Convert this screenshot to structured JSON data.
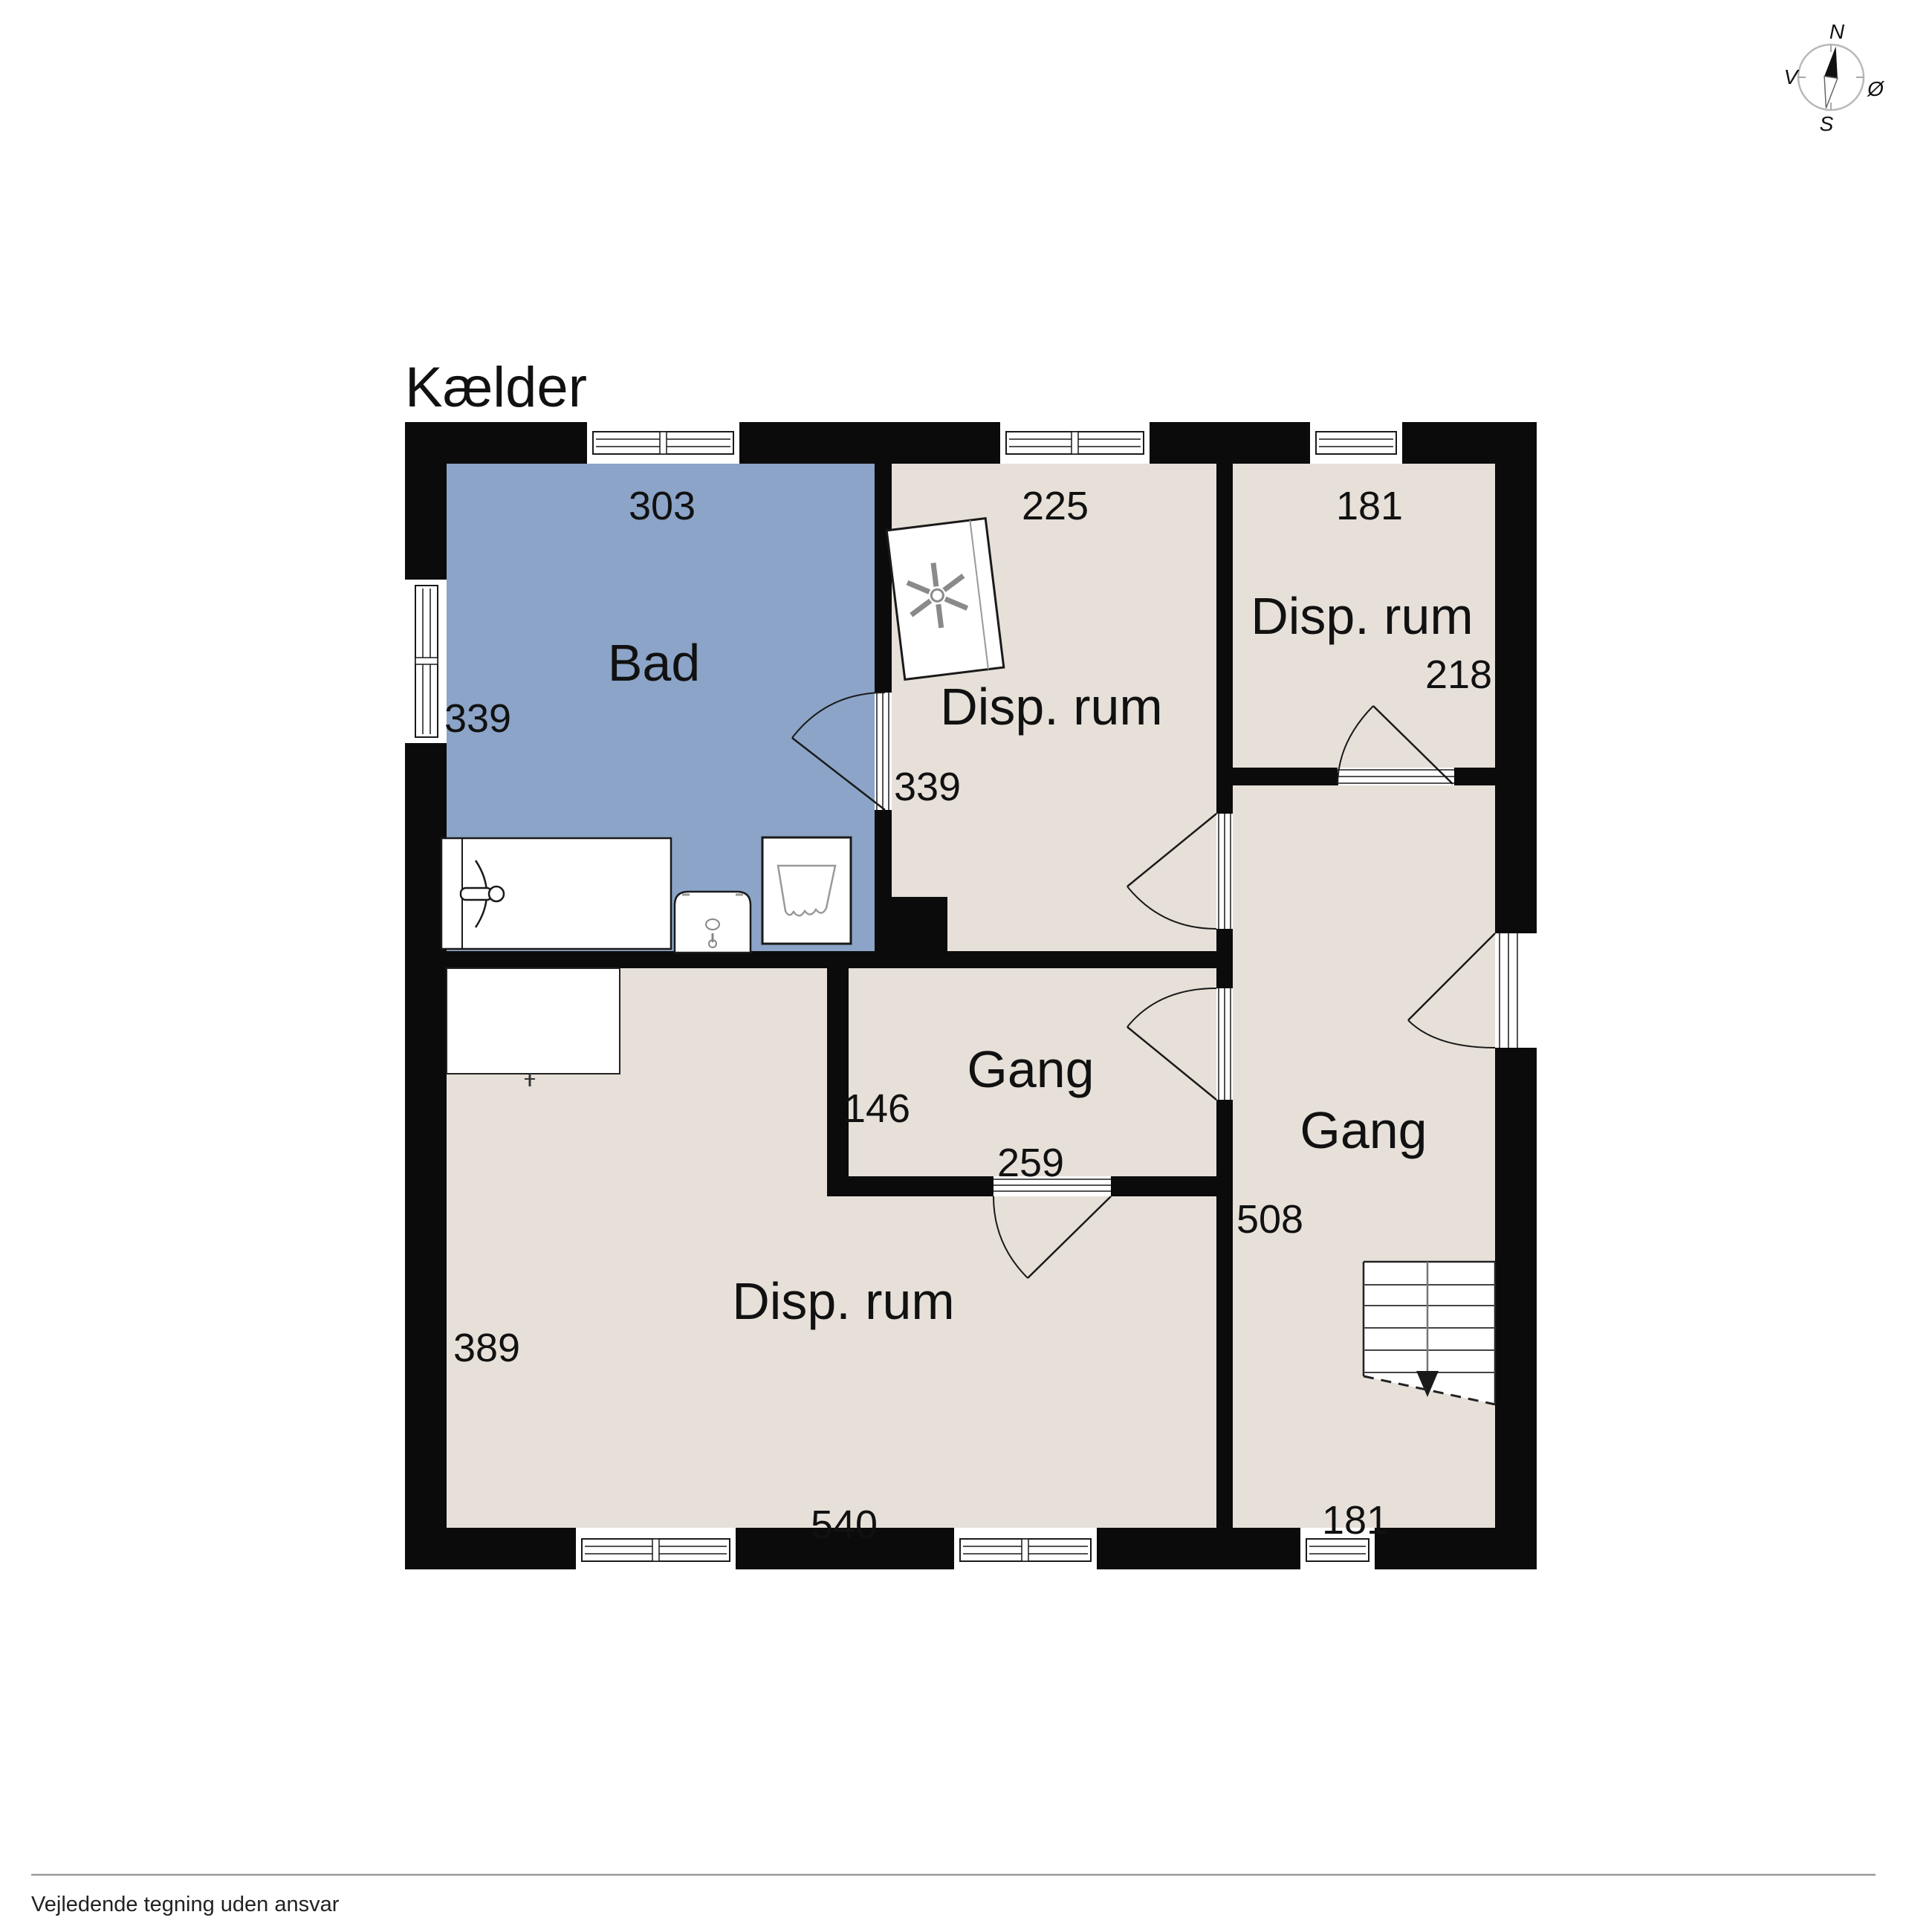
{
  "title": "Kælder",
  "compass": {
    "north_label": "N",
    "south_label": "S",
    "west_label": "V",
    "east_label": "Ø"
  },
  "rooms": {
    "bad": {
      "label": "Bad",
      "width_cm": "303",
      "depth_cm": "339"
    },
    "disp_rum_top_middle": {
      "label": "Disp. rum",
      "width_cm": "225",
      "depth_cm": "339"
    },
    "disp_rum_top_right": {
      "label": "Disp. rum",
      "width_cm": "181",
      "depth_cm": "218"
    },
    "gang_middle": {
      "label": "Gang",
      "depth_cm": "146",
      "width_cm": "259"
    },
    "gang_right": {
      "label": "Gang",
      "depth_cm": "508",
      "width_cm": "181"
    },
    "disp_rum_bottom": {
      "label": "Disp. rum",
      "depth_cm": "389",
      "width_cm": "540"
    }
  },
  "footer": {
    "disclaimer": "Vejledende tegning uden ansvar"
  },
  "colors": {
    "wall": "#0b0b0b",
    "bathroom_fill": "#8ba4c7",
    "room_fill": "#e6e0d9",
    "compass_ring": "#b9b9b9",
    "divider_line": "#9a9a9a"
  }
}
